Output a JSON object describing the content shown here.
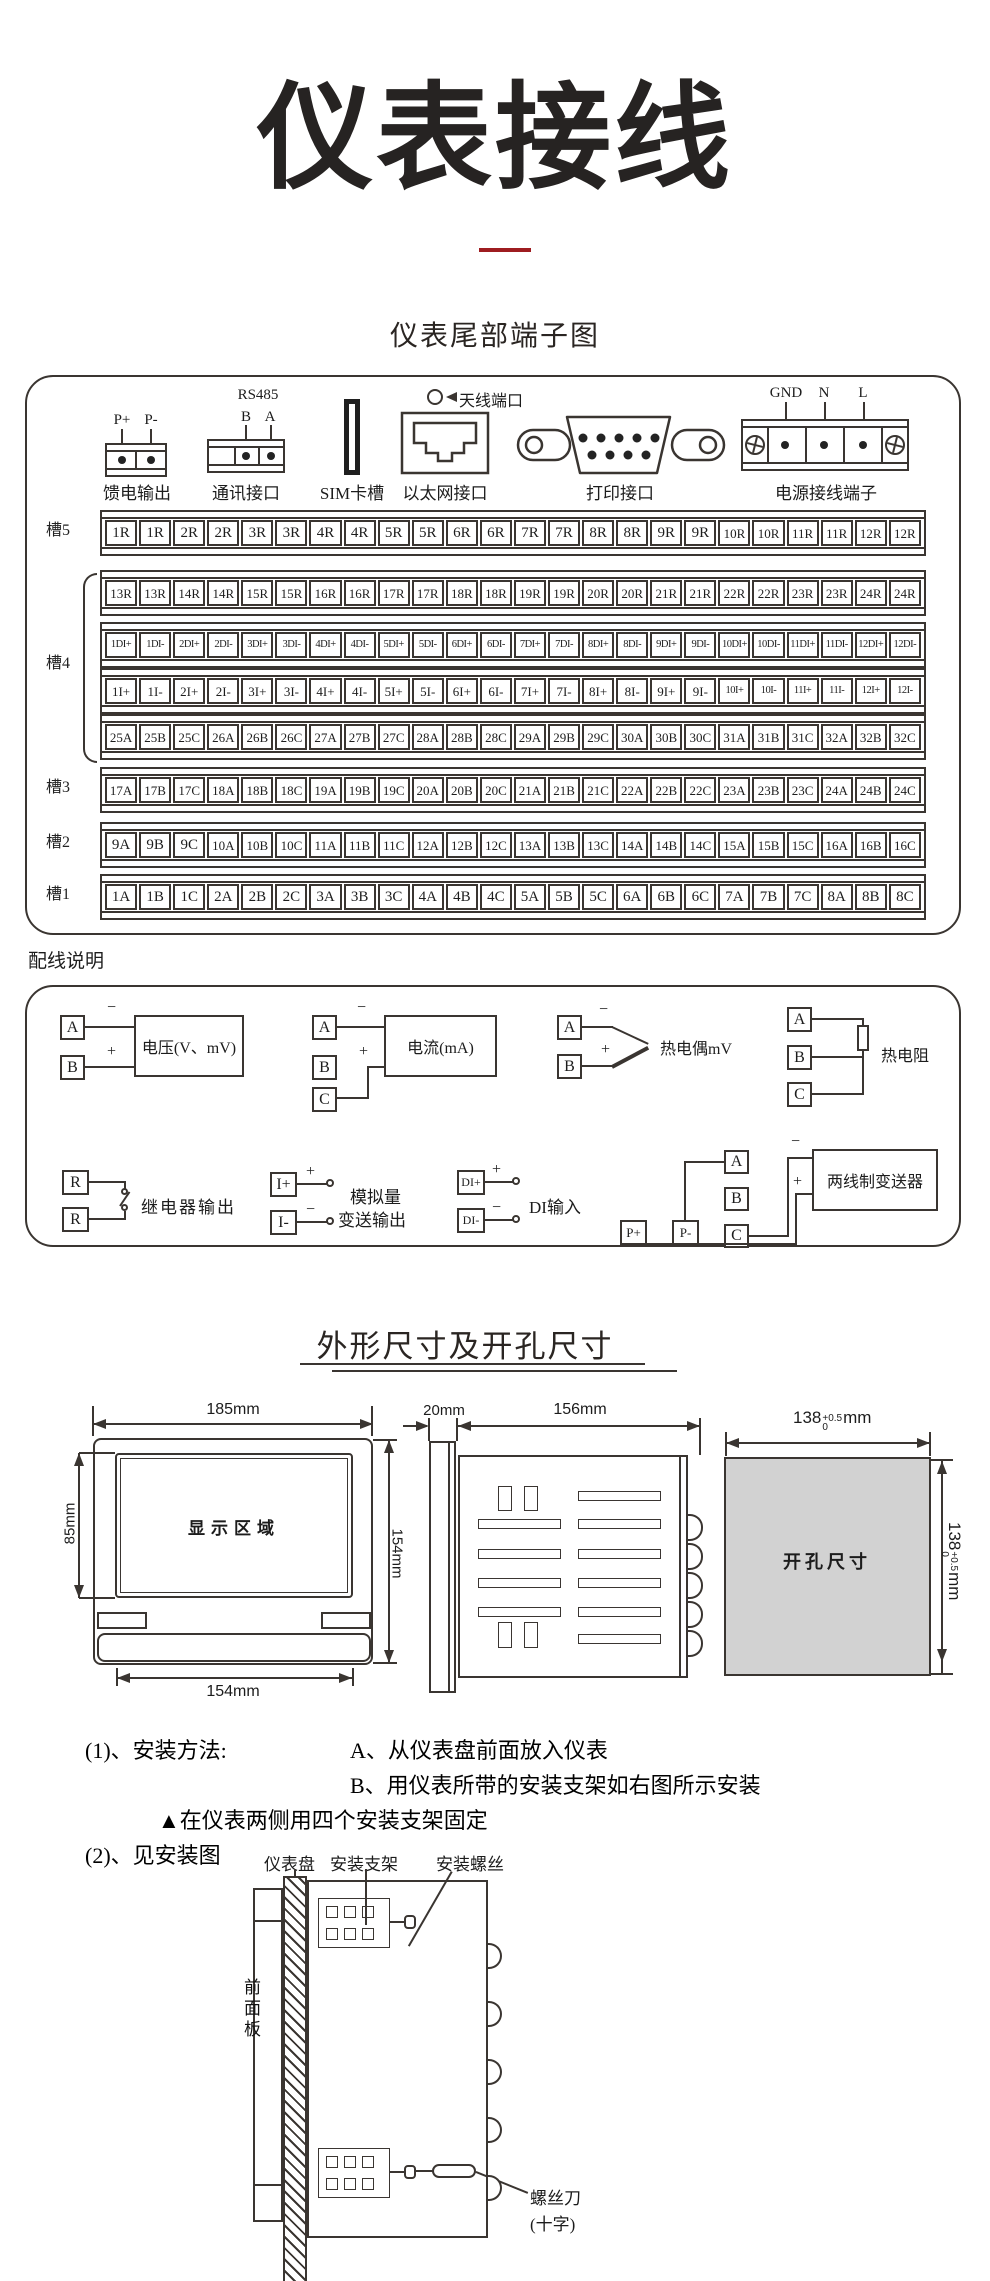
{
  "page": {
    "title": "仪表接线",
    "subtitle": "仪表尾部端子图",
    "wiring_heading": "配线说明",
    "dims_heading": "外形尺寸及开孔尺寸"
  },
  "rear_panel": {
    "feed": {
      "label": "馈电输出",
      "pin_plus": "P+",
      "pin_minus": "P-"
    },
    "comm": {
      "label": "通讯接口",
      "bus": "RS485",
      "pin_b": "B",
      "pin_a": "A"
    },
    "sim": {
      "label": "SIM卡槽"
    },
    "ethernet": {
      "label": "以太网接口"
    },
    "antenna": {
      "label": "天线端口"
    },
    "printer": {
      "label": "打印接口"
    },
    "power": {
      "label": "电源接线端子",
      "pin_gnd": "GND",
      "pin_n": "N",
      "pin_l": "L"
    }
  },
  "slots": [
    {
      "label": "槽5",
      "rows": [
        [
          "1R",
          "1R",
          "2R",
          "2R",
          "3R",
          "3R",
          "4R",
          "4R",
          "5R",
          "5R",
          "6R",
          "6R",
          "7R",
          "7R",
          "8R",
          "8R",
          "9R",
          "9R",
          "10R",
          "10R",
          "11R",
          "11R",
          "12R",
          "12R"
        ]
      ]
    },
    {
      "label": "槽4",
      "rows": [
        [
          "13R",
          "13R",
          "14R",
          "14R",
          "15R",
          "15R",
          "16R",
          "16R",
          "17R",
          "17R",
          "18R",
          "18R",
          "19R",
          "19R",
          "20R",
          "20R",
          "21R",
          "21R",
          "22R",
          "22R",
          "23R",
          "23R",
          "24R",
          "24R"
        ],
        [
          "1DI+",
          "1DI-",
          "2DI+",
          "2DI-",
          "3DI+",
          "3DI-",
          "4DI+",
          "4DI-",
          "5DI+",
          "5DI-",
          "6DI+",
          "6DI-",
          "7DI+",
          "7DI-",
          "8DI+",
          "8DI-",
          "9DI+",
          "9DI-",
          "10DI+",
          "10DI-",
          "11DI+",
          "11DI-",
          "12DI+",
          "12DI-"
        ],
        [
          "1I+",
          "1I-",
          "2I+",
          "2I-",
          "3I+",
          "3I-",
          "4I+",
          "4I-",
          "5I+",
          "5I-",
          "6I+",
          "6I-",
          "7I+",
          "7I-",
          "8I+",
          "8I-",
          "9I+",
          "9I-",
          "10I+",
          "10I-",
          "11I+",
          "11I-",
          "12I+",
          "12I-"
        ],
        [
          "25A",
          "25B",
          "25C",
          "26A",
          "26B",
          "26C",
          "27A",
          "27B",
          "27C",
          "28A",
          "28B",
          "28C",
          "29A",
          "29B",
          "29C",
          "30A",
          "30B",
          "30C",
          "31A",
          "31B",
          "31C",
          "32A",
          "32B",
          "32C"
        ]
      ]
    },
    {
      "label": "槽3",
      "rows": [
        [
          "17A",
          "17B",
          "17C",
          "18A",
          "18B",
          "18C",
          "19A",
          "19B",
          "19C",
          "20A",
          "20B",
          "20C",
          "21A",
          "21B",
          "21C",
          "22A",
          "22B",
          "22C",
          "23A",
          "23B",
          "23C",
          "24A",
          "24B",
          "24C"
        ]
      ]
    },
    {
      "label": "槽2",
      "rows": [
        [
          "9A",
          "9B",
          "9C",
          "10A",
          "10B",
          "10C",
          "11A",
          "11B",
          "11C",
          "12A",
          "12B",
          "12C",
          "13A",
          "13B",
          "13C",
          "14A",
          "14B",
          "14C",
          "15A",
          "15B",
          "15C",
          "16A",
          "16B",
          "16C"
        ]
      ]
    },
    {
      "label": "槽1",
      "rows": [
        [
          "1A",
          "1B",
          "1C",
          "2A",
          "2B",
          "2C",
          "3A",
          "3B",
          "3C",
          "4A",
          "4B",
          "4C",
          "5A",
          "5B",
          "5C",
          "6A",
          "6B",
          "6C",
          "7A",
          "7B",
          "7C",
          "8A",
          "8B",
          "8C"
        ]
      ]
    }
  ],
  "wiring": {
    "voltage": {
      "device": "电压(V、mV)",
      "a": "A",
      "b": "B",
      "plus": "+",
      "minus": "−"
    },
    "current": {
      "device": "电流(mA)",
      "a": "A",
      "b": "B",
      "c": "C",
      "plus": "+",
      "minus": "−"
    },
    "thermocouple": {
      "device": "热电偶mV",
      "a": "A",
      "b": "B",
      "plus": "+",
      "minus": "−"
    },
    "rtd": {
      "device": "热电阻",
      "a": "A",
      "b": "B",
      "c": "C"
    },
    "relay": {
      "label": "继电器输出",
      "r1": "R",
      "r2": "R"
    },
    "analog_out": {
      "label_line1": "模拟量",
      "label_line2": "变送输出",
      "iplus": "I+",
      "iminus": "I-",
      "plus": "+",
      "minus": "−"
    },
    "di": {
      "label": "DI输入",
      "pin_plus": "DI+",
      "pin_minus": "DI-",
      "plus": "+",
      "minus": "−"
    },
    "transmitter": {
      "device": "两线制变送器",
      "pplus": "P+",
      "pminus": "P-",
      "a": "A",
      "b": "B",
      "c": "C",
      "plus": "+",
      "minus": "−"
    }
  },
  "dimensions": {
    "front": {
      "width_top": "185mm",
      "display": "显示区域",
      "height_left": "85mm",
      "height_right": "154mm",
      "width_bottom": "154mm"
    },
    "side": {
      "depth_bezel": "20mm",
      "depth_body": "156mm"
    },
    "cutout": {
      "label": "开孔尺寸",
      "w_value": "138",
      "w_tol_top": "+0.5",
      "w_tol_bottom": "0",
      "w_unit": "mm",
      "h_value": "138",
      "h_tol_top": "+0.5",
      "h_tol_bottom": "0",
      "h_unit": "mm"
    }
  },
  "install": {
    "line1_label": "(1)、安装方法:",
    "line1_text": "A、从仪表盘前面放入仪表",
    "line2_text": "B、用仪表所带的安装支架如右图所示安装",
    "line3_text": "▲在仪表两侧用四个安装支架固定",
    "line4_text": "(2)、见安装图",
    "callout_panel": "仪表盘",
    "callout_bracket": "安装支架",
    "callout_screw": "安装螺丝",
    "callout_front": "前面板",
    "callout_driver_line1": "螺丝刀",
    "callout_driver_line2": "(十字)"
  }
}
